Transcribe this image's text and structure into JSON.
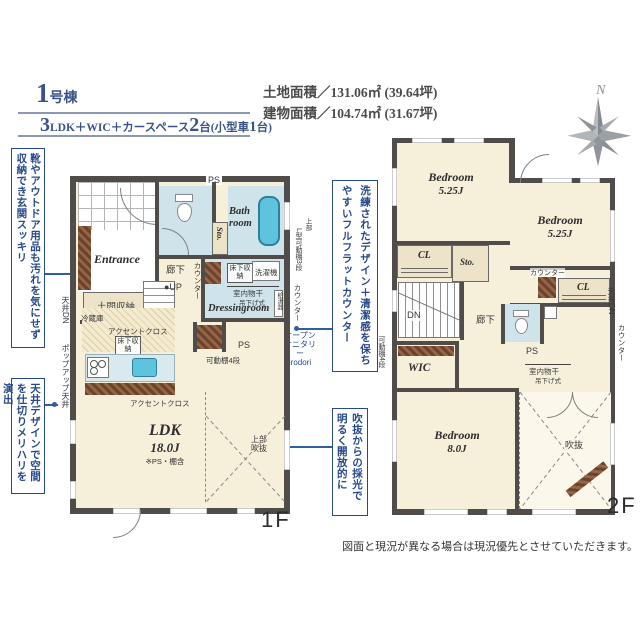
{
  "colors": {
    "wall": "#4f4c49",
    "floor_cream": "#f6efd9",
    "wet_blue": "#cfe3ea",
    "tub_blue": "#5ec4de",
    "wood_brown": "#6b4527",
    "storage_beige": "#ede3c9",
    "accent_navy": "#27498a",
    "leader_blue": "#2e5fa3"
  },
  "header": {
    "building_no": "1",
    "building_suffix": "号棟",
    "spec": {
      "n1": "3",
      "t1": "LDK＋WIC＋カースペース",
      "n2": "2",
      "t2": "台(小型車",
      "n3": "1",
      "t3": "台)"
    },
    "land_area": "土地面積／131.06㎡ (39.64坪)",
    "building_area": "建物面積／104.74㎡ (31.67坪)",
    "compass_n": "N"
  },
  "callouts": {
    "left_top": "靴やアウトドア用品も汚れを気にせず収納でき玄関スッキリ",
    "left_bottom": "天井デザインで空間を仕切りメリハリを演出",
    "center_counter": "洗練されたデザイン＋清潔感を保ちやすいフルフラットカウンター",
    "center_void": "吹抜からの採光で明るく開放的に",
    "open_sanitary_1": "オープン",
    "open_sanitary_2": "サニタリー",
    "open_sanitary_3": "irodori"
  },
  "floor1": {
    "floor_label": "1F",
    "entrance": "Entrance",
    "doma": "土間収納",
    "ps_top": "PS",
    "sto": "Sto.",
    "bath_1": "Bath",
    "bath_2": "room",
    "corridor": "廊下",
    "up": "●UP",
    "counter_left": "カウンター",
    "underfloor_1": "床下収納",
    "washer": "洗濯機",
    "monohoshi": "室内物干",
    "tsurisage": "吊下げ式",
    "dressing": "Dressingroom",
    "water_heater": "給湯器",
    "upper": "上部",
    "l_shelf": "L型可動棚3段",
    "counter_right": "カウンター",
    "ps_mid": "PS",
    "shelf4": "可動棚4段",
    "fridge": "冷蔵庫",
    "accent_1": "アクセントクロス",
    "underfloor_2": "床下収納",
    "accent_2": "アクセントクロス",
    "ldk": "LDK",
    "ldk_size": "18.0J",
    "ldk_note": "※PS・棚含",
    "upper_void_1": "上部",
    "upper_void_2": "吹抜",
    "ceiling_dn": "天井DN",
    "popup_ceiling": "ポップアップ天井"
  },
  "floor2": {
    "floor_label": "2F",
    "bedroom": "Bedroom",
    "b1_size": "5.25J",
    "b2_size": "5.25J",
    "b3_size": "8.0J",
    "cl": "CL",
    "sto": "Sto.",
    "dn": "DN",
    "corridor": "廊下",
    "counter": "カウンター",
    "ps": "PS",
    "monohoshi": "室内物干",
    "tsurisage": "吊下げ式",
    "wic": "WIC",
    "void": "吹抜",
    "shelf4": "可動棚4段",
    "ceiling_dn": "天井DN",
    "counter_right": "カウンター"
  },
  "footer": {
    "disclaimer": "図面と現況が異なる場合は現況優先とさせていただきます。"
  }
}
